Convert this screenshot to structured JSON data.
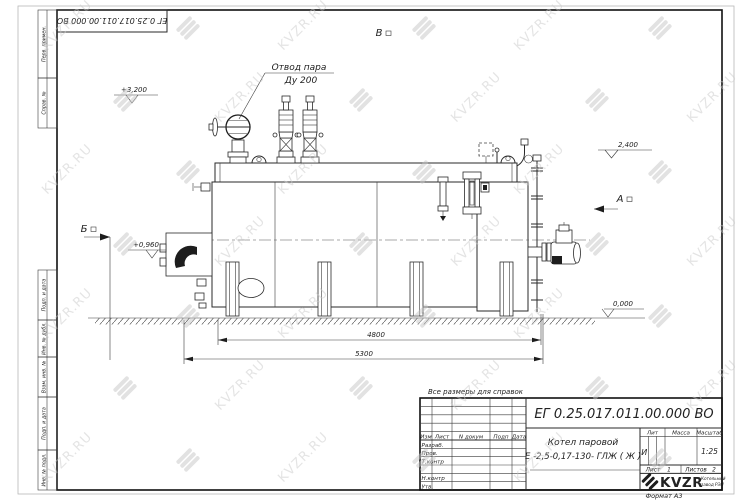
{
  "watermark": {
    "text": "KVZR.RU"
  },
  "frame": {
    "corner_doc_number": "ЕГ 0.25.017.011.00.000  ВО",
    "margin_labels": {
      "perv_primen": "Перв. примен.",
      "sprav_no": "Справ. №",
      "podp_data_1": "Подп. и дата",
      "inv_no_dubl": "Инв. № дубл.",
      "vzam_inv_no": "Взам. инв. №",
      "podp_data_2": "Подп. и дата",
      "inv_no_podl": "Инв. № подл."
    }
  },
  "drawing": {
    "callout_line1": "Отвод пара",
    "callout_line2": "Ду 200",
    "view_top": "В",
    "view_left": "А",
    "view_front": "Б",
    "elev_3200": "+3,200",
    "elev_2400": "2,400",
    "elev_0960": "+0,960",
    "elev_0000": "0,000",
    "dim_4800": "4800",
    "dim_5300": "5300"
  },
  "note_above_stamp": "Все размеры для справок",
  "title_block": {
    "doc_number": "ЕГ 0.25.017.011.00.000  ВО",
    "product_name_line1": "Котел паровой",
    "product_name_line2": "Е -2,5-0,17-130- ГЛЖ ( Ж )",
    "col_izm": "Изм",
    "col_list": "Лист",
    "col_n_dokum": "N докум",
    "col_podp": "Подп",
    "col_data": "Дата",
    "row_razrab": "Разраб.",
    "row_prov": "Пров.",
    "row_t_kontr": "Т.контр",
    "row_n_kontr": "Н.контр",
    "row_utv": "Утв.",
    "lit_header": "Лит",
    "massa_header": "Масса",
    "masshtab_header": "Масштаб",
    "lit_value": "И",
    "scale_value": "1:25",
    "list_label": "Лист",
    "list_value": "1",
    "listov_label": "Листов",
    "listov_value": "2",
    "logo_text": "KVZR",
    "logo_sub_line1": "Котельный",
    "logo_sub_line2": "завод РЭП",
    "format_label": "Формат А3"
  }
}
